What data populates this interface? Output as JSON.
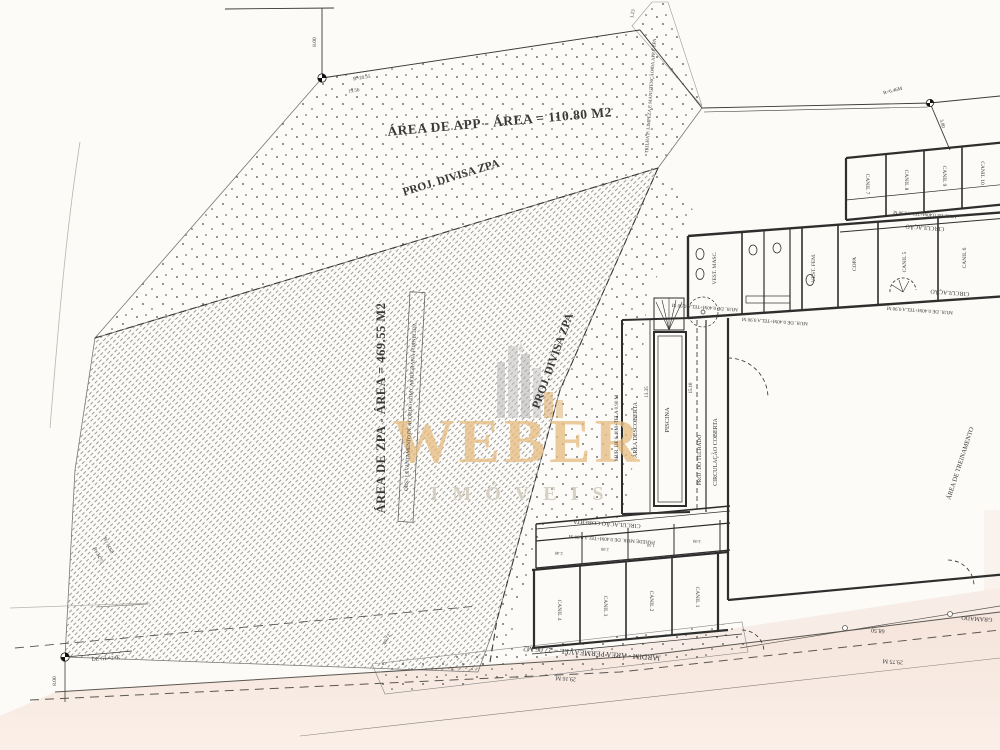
{
  "colors": {
    "paper": "#fcfbf7",
    "ink": "#3a3a3a",
    "hatch": "#8f8f8f",
    "dots": "#4a4a4a",
    "pink": "#f4e3d9",
    "pink_light": "#f9ece4",
    "watermark_gold": "#e7bd83",
    "watermark_grey": "#d6cec2",
    "logo_grey": "#b9b9b9"
  },
  "watermark": {
    "brand": "WEBER",
    "subtitle": "IMÓVEIS"
  },
  "labels": [
    {
      "id": "area-app-label",
      "text": "ÁREA DE APP - ÁREA = 110.80 M2",
      "x": 500,
      "y": 126,
      "rot": -5,
      "size": 13.5,
      "bold": true,
      "ls": 0.5
    },
    {
      "id": "proj-divisa-zpa-top-label",
      "text": "PROJ. DIVISA ZPA",
      "x": 452,
      "y": 181,
      "rot": -17,
      "size": 11.5,
      "bold": true
    },
    {
      "id": "proj-divisa-zpa-right-label",
      "text": "PROJ. DIVISA ZPA",
      "x": 556,
      "y": 362,
      "rot": -70,
      "size": 11.5,
      "bold": true
    },
    {
      "id": "area-zpa-label",
      "text": "ÁREA DE ZPA - ÁREA = 469.55 M2",
      "x": 385,
      "y": 408,
      "rot": -90,
      "size": 12.5,
      "bold": true,
      "ls": 0.5
    },
    {
      "id": "obs-note-label",
      "text": "OBS.: LEVANTAMENTO DE ACORDO COM CARTOGRAFIA FORNECIDA",
      "x": 412,
      "y": 407,
      "rot": -87,
      "size": 5.2
    },
    {
      "id": "trilha-note-label",
      "text": "TRILHA P/ LIMPEZA E MANUTENÇÃO DA APP E ZPA",
      "x": 652,
      "y": 96,
      "rot": -86,
      "size": 4.8
    },
    {
      "id": "area-treinamento-label",
      "text": "ÁREA DE TREINAMENTO",
      "x": 962,
      "y": 464,
      "rot": -72,
      "size": 6.5
    },
    {
      "id": "gramado-label",
      "text": "GRAMADO",
      "x": 977,
      "y": 617,
      "rot": 184,
      "size": 6
    },
    {
      "id": "jardim-label",
      "text": "JARDIM - ÁREA PERMEÁVEL = 27.06 M2",
      "x": 592,
      "y": 651,
      "rot": 184,
      "size": 7.5
    },
    {
      "id": "dim-29-16",
      "text": "29.16 M",
      "x": 566,
      "y": 677,
      "rot": 184,
      "size": 6
    },
    {
      "id": "circulacao-strip-label",
      "text": "CIRCULAÇÃO",
      "x": 925,
      "y": 226,
      "rot": 184,
      "size": 6
    },
    {
      "id": "circulacao-arc-label",
      "text": "CIRCULAÇÃO",
      "x": 950,
      "y": 291,
      "rot": 184,
      "size": 6
    },
    {
      "id": "circulacao-coberta-mid-label",
      "text": "CIRCULAÇÃO COBERTA",
      "x": 717,
      "y": 452,
      "rot": -90,
      "size": 6
    },
    {
      "id": "proj-telhado-label",
      "text": "PROJ. DO TELHADO",
      "x": 701,
      "y": 460,
      "rot": -90,
      "size": 5.5
    },
    {
      "id": "piscina-label",
      "text": "PISCINA",
      "x": 669,
      "y": 420,
      "rot": -90,
      "size": 6.5
    },
    {
      "id": "area-descoberta-label",
      "text": "ÁREA DESCOBERTA",
      "x": 637,
      "y": 430,
      "rot": -90,
      "size": 6
    },
    {
      "id": "circulacao-coberta-bottom-label",
      "text": "CIRCULAÇÃO COBERTA",
      "x": 607,
      "y": 522,
      "rot": 184,
      "size": 6
    },
    {
      "id": "parede-mur-bottom-label",
      "text": "PAREDE  MUR. DE 0.40M+TELA 0.90 M",
      "x": 612,
      "y": 538,
      "rot": 184,
      "size": 5
    },
    {
      "id": "mur-left-label",
      "text": "MUR. DE 0.40M+TELA 0.90 M",
      "x": 618,
      "y": 428,
      "rot": -90,
      "size": 5
    },
    {
      "id": "mur-top-room-label",
      "text": "MUR. DE 0.40M+TELA 0.90 M",
      "x": 705,
      "y": 306,
      "rot": 184,
      "size": 5
    },
    {
      "id": "mur-main-1-label",
      "text": "MUR. DE 0.40M+TELA 0.90 M",
      "x": 775,
      "y": 320,
      "rot": 184,
      "size": 5
    },
    {
      "id": "mur-main-2-label",
      "text": "MUR. DE 0.40M+TELA 0.90 M",
      "x": 920,
      "y": 309,
      "rot": 184,
      "size": 5
    },
    {
      "id": "mur-strip-label",
      "text": "MUR. DE 0.40M+TELA 0.90 M",
      "x": 925,
      "y": 213,
      "rot": 184,
      "size": 4.8
    },
    {
      "id": "vest-masc-label",
      "text": "VEST. MASC.",
      "x": 716,
      "y": 268,
      "rot": -90,
      "size": 5.5
    },
    {
      "id": "vest-fem-label",
      "text": "VEST. FEM.",
      "x": 815,
      "y": 268,
      "rot": -90,
      "size": 5.5
    },
    {
      "id": "copa-label",
      "text": "COPA",
      "x": 856,
      "y": 264,
      "rot": -90,
      "size": 5.5
    },
    {
      "id": "canil-5-label",
      "text": "CANIL 5",
      "x": 906,
      "y": 262,
      "rot": -90,
      "size": 5.5
    },
    {
      "id": "canil-6-label",
      "text": "CANIL 6",
      "x": 966,
      "y": 258,
      "rot": -90,
      "size": 5.5
    },
    {
      "id": "canil-7-label",
      "text": "CANIL 7",
      "x": 866,
      "y": 184,
      "rot": 90,
      "size": 5.5
    },
    {
      "id": "canil-8-label",
      "text": "CANIL 8",
      "x": 905,
      "y": 180,
      "rot": 90,
      "size": 5.5
    },
    {
      "id": "canil-9-label",
      "text": "CANIL 9",
      "x": 943,
      "y": 176,
      "rot": 90,
      "size": 5.5
    },
    {
      "id": "canil-10-label",
      "text": "CANIL 10",
      "x": 981,
      "y": 173,
      "rot": 90,
      "size": 5.5
    },
    {
      "id": "canil-4-label",
      "text": "CANIL 4",
      "x": 558,
      "y": 610,
      "rot": 90,
      "size": 5.5
    },
    {
      "id": "canil-3-label",
      "text": "CANIL 3",
      "x": 604,
      "y": 606,
      "rot": 90,
      "size": 5.5
    },
    {
      "id": "canil-2-label",
      "text": "CANIL 2",
      "x": 650,
      "y": 601,
      "rot": 90,
      "size": 5.5
    },
    {
      "id": "canil-1-label",
      "text": "CANIL 1",
      "x": 696,
      "y": 597,
      "rot": 90,
      "size": 5.5
    },
    {
      "id": "dim-8-00-top",
      "text": "8.00",
      "x": 316,
      "y": 42,
      "rot": -90,
      "size": 5.5
    },
    {
      "id": "dim-b-20-55",
      "text": "B=20.55",
      "x": 362,
      "y": 79,
      "rot": -9,
      "size": 5
    },
    {
      "id": "dim-19-56",
      "text": "19.56",
      "x": 354,
      "y": 92,
      "rot": -9,
      "size": 5
    },
    {
      "id": "dim-1-23",
      "text": "1.23",
      "x": 634,
      "y": 14,
      "rot": -80,
      "size": 5
    },
    {
      "id": "dim-r-6-46",
      "text": "R=6.46M",
      "x": 893,
      "y": 92,
      "rot": -14,
      "size": 5
    },
    {
      "id": "dim-3-80",
      "text": "3.80",
      "x": 941,
      "y": 124,
      "rot": 75,
      "size": 5
    },
    {
      "id": "dim-68-50",
      "text": "68.50",
      "x": 878,
      "y": 629,
      "rot": 184,
      "size": 6
    },
    {
      "id": "dim-29-75",
      "text": "29.75 M",
      "x": 893,
      "y": 660,
      "rot": 184,
      "size": 6
    },
    {
      "id": "marker-label-bl",
      "text": "DE GL=2+E",
      "x": 106,
      "y": 660,
      "rot": -4,
      "size": 5.5
    },
    {
      "id": "dim-8-00-bl",
      "text": "8.00",
      "x": 56,
      "y": 681,
      "rot": -90,
      "size": 5.5
    },
    {
      "id": "dim-r-34-73",
      "text": "R=34.73",
      "x": 97,
      "y": 556,
      "rot": 64,
      "size": 5
    },
    {
      "id": "dim-b-74-50",
      "text": "B=74.50",
      "x": 107,
      "y": 546,
      "rot": 64,
      "size": 5
    },
    {
      "id": "dim-40-72",
      "text": "40.72",
      "x": 388,
      "y": 640,
      "rot": -62,
      "size": 5
    },
    {
      "id": "dim-13-35",
      "text": "13.35",
      "x": 648,
      "y": 392,
      "rot": -90,
      "size": 5
    },
    {
      "id": "dim-15-10",
      "text": "15.10",
      "x": 692,
      "y": 388,
      "rot": -90,
      "size": 4.8
    },
    {
      "id": "dim-2-40",
      "text": "2.40",
      "x": 559,
      "y": 552,
      "rot": 184,
      "size": 4.5
    },
    {
      "id": "dim-2-00",
      "text": "2.00",
      "x": 605,
      "y": 548,
      "rot": 184,
      "size": 4.5
    },
    {
      "id": "dim-1-50",
      "text": "1.50",
      "x": 651,
      "y": 544,
      "rot": 184,
      "size": 4.5
    },
    {
      "id": "dim-3-00",
      "text": "3.00",
      "x": 697,
      "y": 540,
      "rot": 184,
      "size": 4.5
    }
  ]
}
